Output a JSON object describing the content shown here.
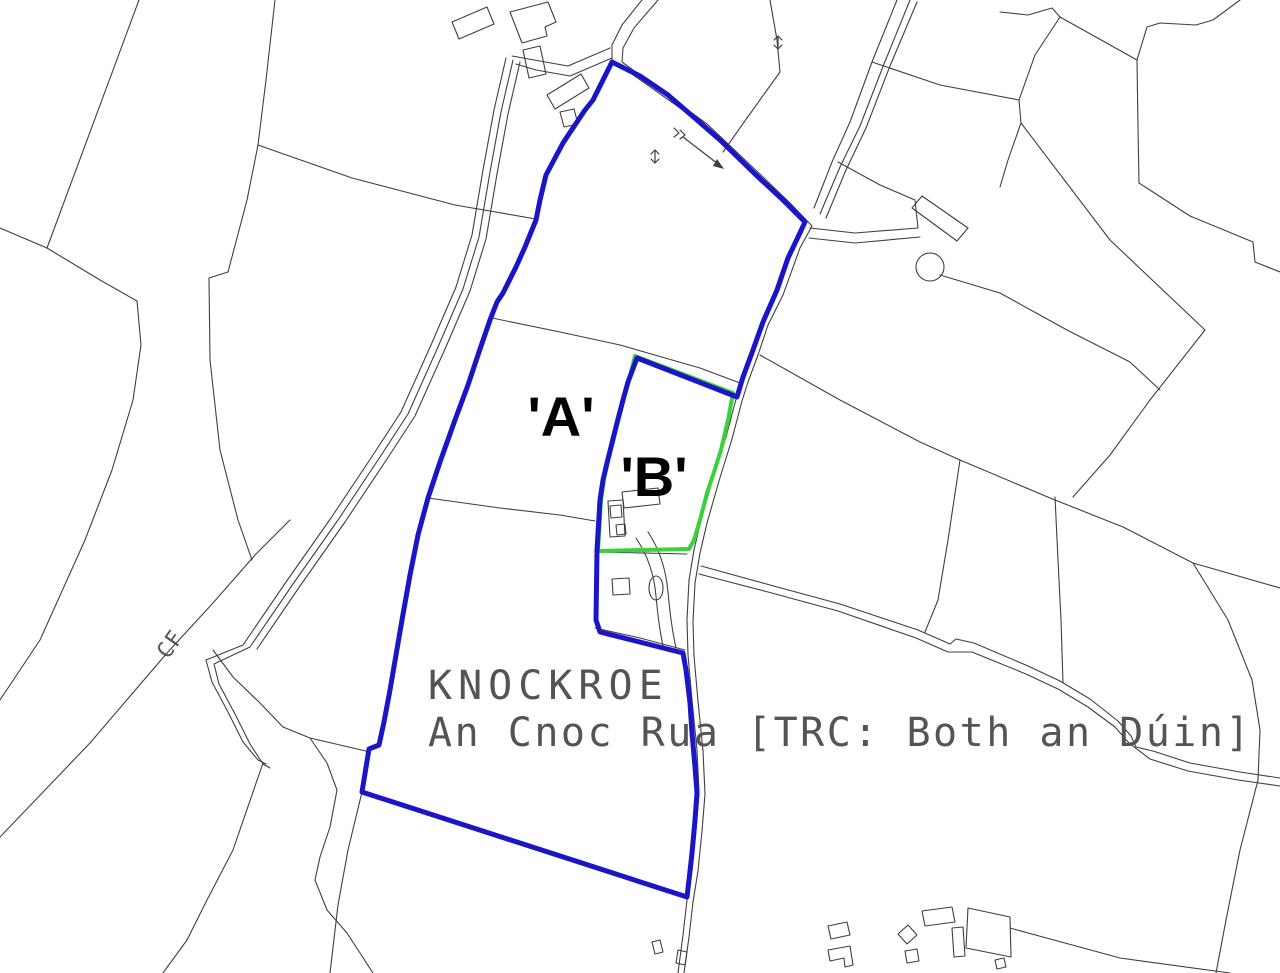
{
  "map": {
    "type": "cadastral-land-registry-plan",
    "labels": {
      "parcel_a": "'A'",
      "parcel_b": "'B'",
      "townland": "KNOCKROE",
      "townland_irish": "An Cnoc Rua [TRC: Both an Dúin]",
      "road_annotation": "CF"
    },
    "colors": {
      "background": "#ffffff",
      "parcel_a_outline": "#1a16c8",
      "parcel_b_outline": "#3ad13a",
      "boundary_line": "#3f3f3f",
      "label_text": "#000000",
      "townland_text": "#545454"
    }
  }
}
